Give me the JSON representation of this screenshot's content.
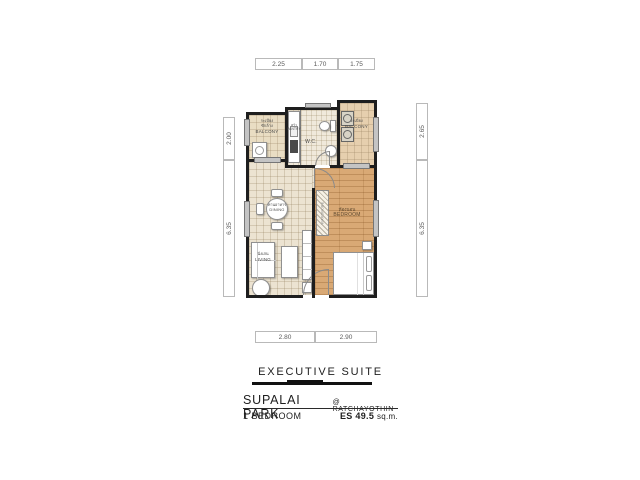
{
  "dimensions": {
    "top": [
      "2.25",
      "1.70",
      "1.75"
    ],
    "left": [
      "2.00",
      "6.35"
    ],
    "right": [
      "2.65",
      "6.35"
    ],
    "bottom": [
      "2.80",
      "2.90"
    ]
  },
  "rooms": {
    "balcony_left": {
      "thai1": "ระเบียง",
      "thai2": "ซักล้าง",
      "en": "BALCONY"
    },
    "pantry": {
      "thai": "ครัว",
      "en": "PANTRY"
    },
    "wc": {
      "en": "W.C."
    },
    "balcony_right": {
      "thai": "ระเบียง",
      "en": "BALCONY"
    },
    "dining": {
      "thai": "ทานอาหาร",
      "en": "DINING"
    },
    "living": {
      "thai": "นั่งเล่น",
      "en": "LIVING"
    },
    "bedroom": {
      "thai": "ห้องนอน",
      "en": "BEDROOM"
    },
    "wardrobe": {
      "en": "WARDROBE"
    }
  },
  "title_block": {
    "suite_name": "EXECUTIVE SUITE",
    "project_name": "SUPALAI PARK",
    "project_location": "@ RATCHAYOTHIN",
    "unit_type": "1 BEDROOM",
    "area_code": "ES",
    "area_value": "49.5",
    "area_unit": "sq.m."
  },
  "colors": {
    "wall": "#1e1e1e",
    "tile_floor": "#ece3d1",
    "wc_floor": "#f0e9db",
    "balcony_left_floor": "#e9ddc3",
    "balcony_right_floor": "#e6cfae",
    "wood_floor": "#d9a975",
    "window_gray": "#c4c4c4",
    "dimension_text": "#5a5a5a",
    "title_text": "#1e1e1e"
  }
}
